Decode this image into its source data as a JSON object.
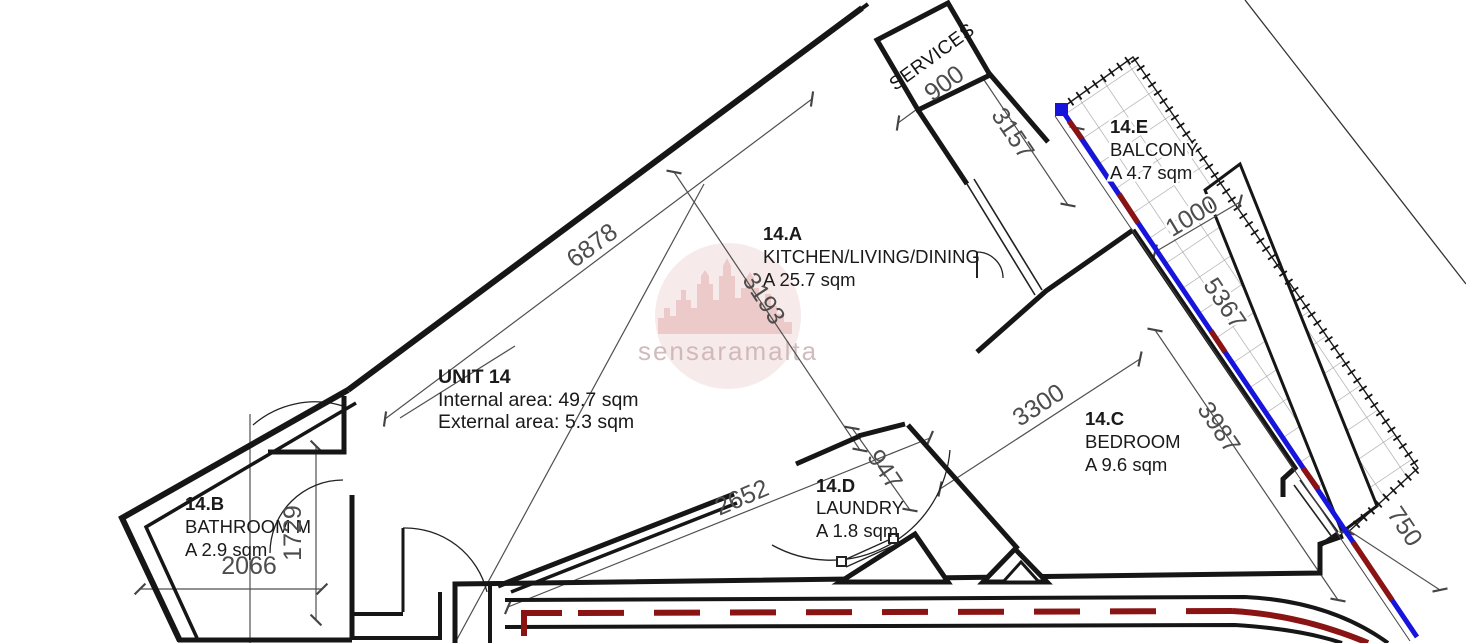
{
  "watermark": {
    "text": "sensaramalta"
  },
  "unit_info": {
    "title": "UNIT 14",
    "internal": "Internal area: 49.7 sqm",
    "external": "External area: 5.3 sqm"
  },
  "rooms": [
    {
      "id": "14.A",
      "name": "KITCHEN/LIVING/DINING",
      "area": "A 25.7 sqm"
    },
    {
      "id": "14.B",
      "name": "BATHROOM M",
      "area": "A 2.9 sqm"
    },
    {
      "id": "14.C",
      "name": "BEDROOM",
      "area": "A 9.6 sqm"
    },
    {
      "id": "14.D",
      "name": "LAUNDRY",
      "area": "A 1.8 sqm"
    },
    {
      "id": "14.E",
      "name": "BALCONY",
      "area": "A 4.7 sqm"
    }
  ],
  "labels": {
    "services": "SERVICES"
  },
  "dims": {
    "d6878": "6878",
    "d3193": "3193",
    "d900": "900",
    "d3157": "3157",
    "d1000": "1000",
    "d5367": "5367",
    "d3300": "3300",
    "d3987": "3987",
    "d947": "947",
    "d2652": "2652",
    "d1729": "1729",
    "d2066": "2066",
    "d750": "750"
  },
  "colors": {
    "wall": "#161616",
    "dim_line": "#4f4f4f",
    "glass_blue": "#1714dc",
    "boundary_red": "#8a1414",
    "watermark_pink": "#f4e3e3",
    "watermark_castle": "#eac6c6",
    "watermark_text": "#cdb4b4"
  }
}
